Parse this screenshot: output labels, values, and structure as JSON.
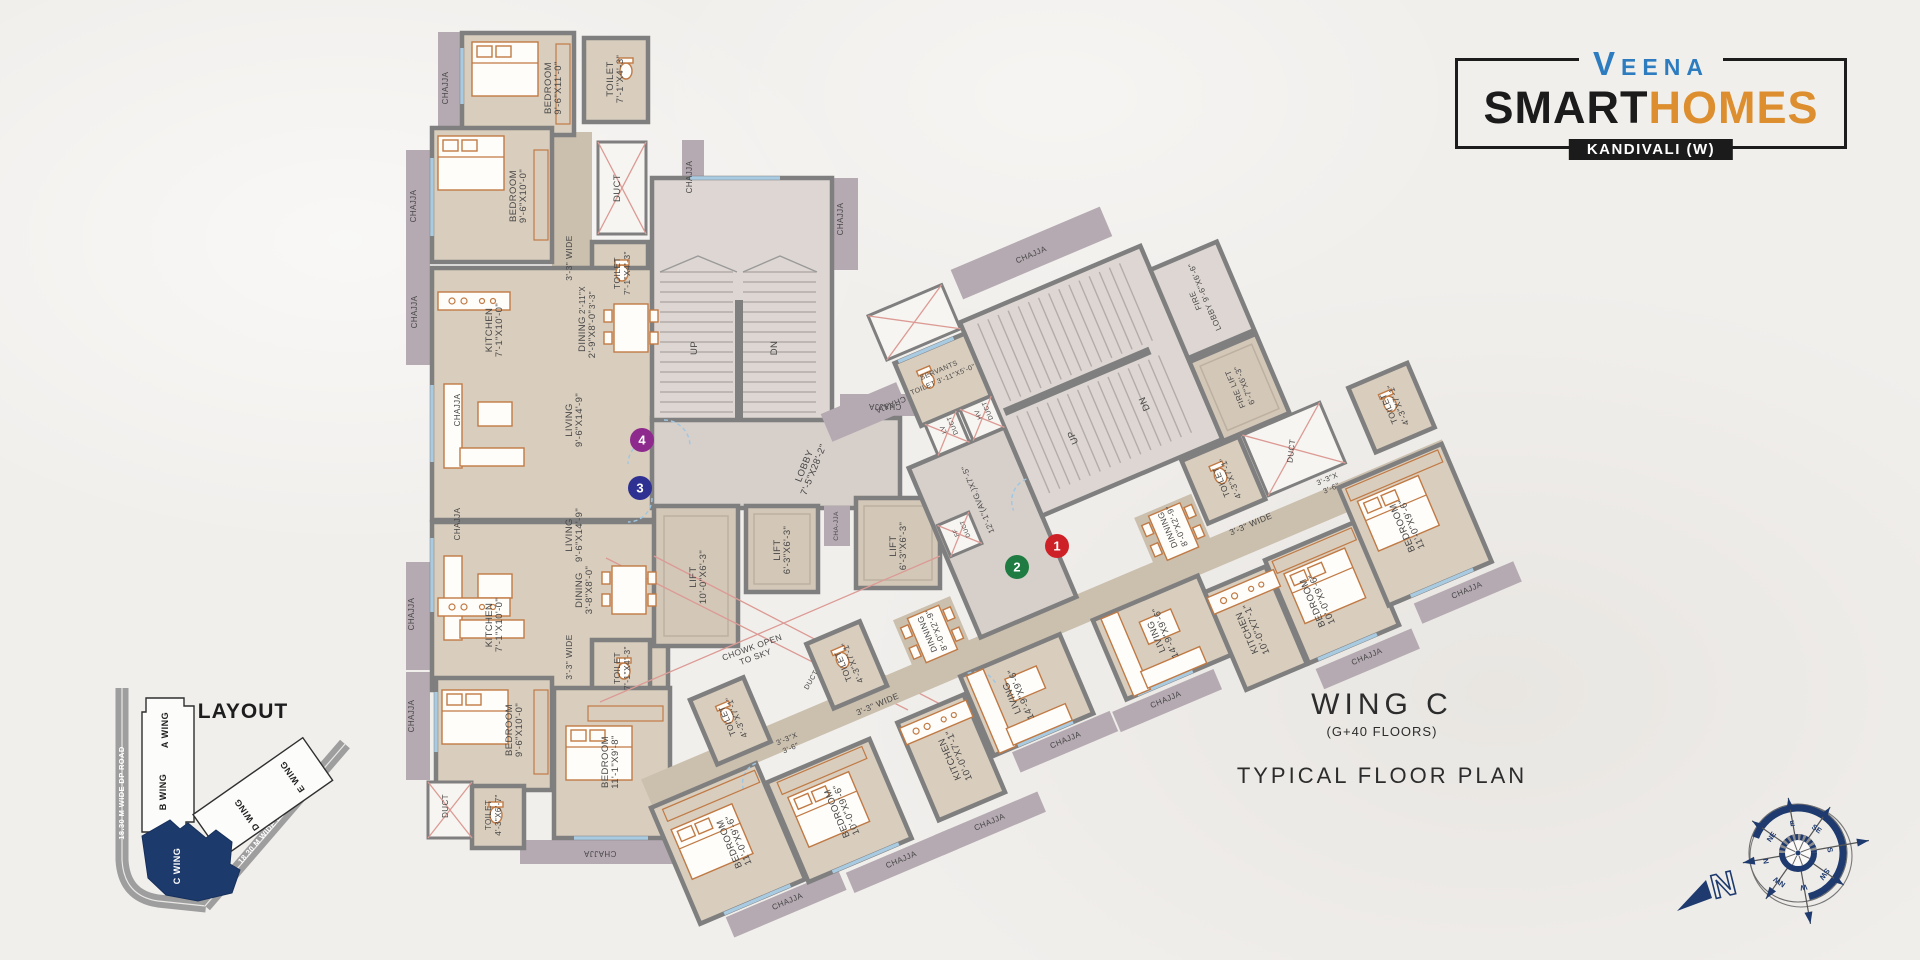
{
  "logo": {
    "brand": "VEENA",
    "smart": "SMART",
    "homes": "HOMES",
    "location": "KANDIVALI (W)"
  },
  "title": {
    "wing": "WING C",
    "floors": "(G+40 FLOORS)",
    "plan": "TYPICAL FLOOR PLAN"
  },
  "layout_map": {
    "title": "LAYOUT",
    "road_left": "18.30 M WIDE DP ROAD",
    "road_right": "18.30 M WIDE DP ROAD",
    "wings": [
      "A WING",
      "B WING",
      "C WING",
      "D WING",
      "E WING"
    ],
    "highlight_color": "#1d3a6d"
  },
  "compass": {
    "north": "N",
    "points": [
      "N",
      "NE",
      "E",
      "SE",
      "S",
      "SW",
      "W",
      "NW"
    ]
  },
  "badges": [
    {
      "label": "1",
      "color": "#ce2127"
    },
    {
      "label": "2",
      "color": "#1e7b41"
    },
    {
      "label": "3",
      "color": "#2e3192"
    },
    {
      "label": "4",
      "color": "#8e2a8d"
    }
  ],
  "plan_labels": [
    {
      "name": "BEDROOM",
      "dims": "9'-6\"X11'-0\"",
      "x": 551,
      "y": 88,
      "r": -90,
      "f": "L"
    },
    {
      "name": "TOILET",
      "dims": "7'-1\"X4'-3\"",
      "x": 613,
      "y": 79,
      "r": -90,
      "f": "L"
    },
    {
      "name": "BEDROOM",
      "dims": "9'-6\"X10'-0\"",
      "x": 516,
      "y": 196,
      "r": -90,
      "f": "L"
    },
    {
      "name": "2'-11\"X",
      "dims": "3'-3\"",
      "x": 585,
      "y": 300,
      "r": -90,
      "f": "L",
      "s": 8
    },
    {
      "name": "DUCT",
      "dims": "",
      "x": 620,
      "y": 188,
      "r": -90,
      "f": "L"
    },
    {
      "name": "TOILET",
      "dims": "7'-1\"X4'-3\"",
      "x": 620,
      "y": 273,
      "r": -90,
      "f": "L",
      "s": 8.5
    },
    {
      "name": "3'-3\" WIDE",
      "dims": "",
      "x": 572,
      "y": 258,
      "r": -90,
      "f": "L",
      "s": 8.5
    },
    {
      "name": "KITCHEN",
      "dims": "7'-1\"X10'-0\"",
      "x": 492,
      "y": 330,
      "r": -90,
      "f": "L"
    },
    {
      "name": "DINING",
      "dims": "2'-9\"X8'-0\"",
      "x": 585,
      "y": 334,
      "r": -90,
      "f": "L"
    },
    {
      "name": "LIVING",
      "dims": "9'-6\"X14'-9\"",
      "x": 572,
      "y": 420,
      "r": -90,
      "f": "L"
    },
    {
      "name": "LIVING",
      "dims": "9'-6\"X14'-9\"",
      "x": 572,
      "y": 535,
      "r": -90,
      "f": "L"
    },
    {
      "name": "DINING",
      "dims": "3'-8\"X8'-0\"",
      "x": 582,
      "y": 590,
      "r": -90,
      "f": "L"
    },
    {
      "name": "KITCHEN",
      "dims": "7'-1\"X10'-0\"",
      "x": 492,
      "y": 625,
      "r": -90,
      "f": "L"
    },
    {
      "name": "3'-3\" WIDE",
      "dims": "",
      "x": 572,
      "y": 657,
      "r": -90,
      "f": "L",
      "s": 8.5
    },
    {
      "name": "TOILET",
      "dims": "7'-1\"X4'-3\"",
      "x": 620,
      "y": 668,
      "r": -90,
      "f": "L",
      "s": 8.5
    },
    {
      "name": "BEDROOM",
      "dims": "9'-6\"X10'-0\"",
      "x": 512,
      "y": 730,
      "r": -90,
      "f": "L"
    },
    {
      "name": "BEDROOM",
      "dims": "11'-1\"X9'-8\"",
      "x": 608,
      "y": 762,
      "r": -90,
      "f": "L"
    },
    {
      "name": "TOILET",
      "dims": "4'-3\"X6'-7\"",
      "x": 491,
      "y": 815,
      "r": -90,
      "f": "L",
      "s": 8
    },
    {
      "name": "DUCT",
      "dims": "",
      "x": 448,
      "y": 806,
      "r": -90,
      "f": "L",
      "s": 8
    },
    {
      "name": "UP",
      "dims": "",
      "x": 697,
      "y": 348,
      "r": -90,
      "f": "L"
    },
    {
      "name": "DN",
      "dims": "",
      "x": 777,
      "y": 348,
      "r": -90,
      "f": "L"
    },
    {
      "name": "LOBBY",
      "dims": "7'-5\"X28'-2\"",
      "x": 807,
      "y": 467,
      "r": -68,
      "f": "L"
    },
    {
      "name": "LIFT",
      "dims": "10'-0\"X6'-3\"",
      "x": 696,
      "y": 577,
      "r": -90,
      "f": "L"
    },
    {
      "name": "LIFT",
      "dims": "6'-3\"X6'-3\"",
      "x": 780,
      "y": 550,
      "r": -90,
      "f": "L"
    },
    {
      "name": "LIFT",
      "dims": "6'-3\"X6'-3\"",
      "x": 896,
      "y": 546,
      "r": -90,
      "f": "L"
    },
    {
      "name": "CHA-JJA",
      "dims": "",
      "x": 838,
      "y": 526,
      "r": -90,
      "f": "L",
      "s": 6.5
    },
    {
      "name": "CHOWK OPEN",
      "dims": "TO SKY",
      "x": 753,
      "y": 650,
      "r": -20,
      "f": "L",
      "s": 8.5
    },
    {
      "name": "DUCT",
      "dims": "",
      "x": 813,
      "y": 681,
      "r": -60,
      "f": "L",
      "s": 7
    },
    {
      "name": "CHAJJA",
      "dims": "",
      "x": 448,
      "y": 88,
      "r": -90,
      "f": "L",
      "s": 8
    },
    {
      "name": "CHAJJA",
      "dims": "",
      "x": 416,
      "y": 206,
      "r": -90,
      "f": "L",
      "s": 8
    },
    {
      "name": "CHAJJA",
      "dims": "",
      "x": 417,
      "y": 312,
      "r": -90,
      "f": "L",
      "s": 8
    },
    {
      "name": "CHAJJA",
      "dims": "",
      "x": 460,
      "y": 410,
      "r": -90,
      "f": "L",
      "s": 8
    },
    {
      "name": "CHAJJA",
      "dims": "",
      "x": 460,
      "y": 524,
      "r": -90,
      "f": "L",
      "s": 8
    },
    {
      "name": "CHAJJA",
      "dims": "",
      "x": 414,
      "y": 614,
      "r": -90,
      "f": "L",
      "s": 8
    },
    {
      "name": "CHAJJA",
      "dims": "",
      "x": 414,
      "y": 716,
      "r": -90,
      "f": "L",
      "s": 8
    },
    {
      "name": "CHAJJA",
      "dims": "",
      "x": 600,
      "y": 851,
      "r": 180,
      "f": "L",
      "s": 8
    },
    {
      "name": "CHAJJA",
      "dims": "",
      "x": 692,
      "y": 177,
      "r": -90,
      "f": "L",
      "s": 8
    },
    {
      "name": "CHAJJA",
      "dims": "",
      "x": 843,
      "y": 219,
      "r": -90,
      "f": "L",
      "s": 8
    },
    {
      "name": "CHAJJA",
      "dims": "",
      "x": 885,
      "y": 404,
      "r": 180,
      "f": "L",
      "s": 8
    },
    {
      "name": "SERVANTS",
      "dims": "TOILET 3'-11\"X5'-0\"",
      "x": 1074,
      "y": 428,
      "r": 0,
      "f": "W",
      "s": 7
    },
    {
      "name": "LV",
      "dims": "DUCT",
      "x": 1057,
      "y": 482,
      "r": -90,
      "f": "W",
      "s": 6.5
    },
    {
      "name": "HV",
      "dims": "DUCT",
      "x": 1095,
      "y": 482,
      "r": -90,
      "f": "W",
      "s": 6.5
    },
    {
      "name": "UP",
      "dims": "",
      "x": 1174,
      "y": 540,
      "r": -90,
      "f": "W"
    },
    {
      "name": "DN",
      "dims": "",
      "x": 1253,
      "y": 537,
      "r": -90,
      "f": "W"
    },
    {
      "name": "FIRE",
      "dims": "LOBBY 9'-6\"X6'-6\"",
      "x": 1340,
      "y": 462,
      "r": -90,
      "f": "W",
      "s": 8
    },
    {
      "name": "FIRE LIFT",
      "dims": "6'-7\"X6'-3\"",
      "x": 1342,
      "y": 559,
      "r": -90,
      "f": "W",
      "s": 8
    },
    {
      "name": "12'-1\"(AVG.)X7'-5\"",
      "dims": "",
      "x": 1062,
      "y": 560,
      "r": -90,
      "f": "W",
      "s": 8
    },
    {
      "name": "FF",
      "dims": "DUCT",
      "x": 1028,
      "y": 582,
      "r": -90,
      "f": "W",
      "s": 6
    },
    {
      "name": "TOILET",
      "dims": "4'-3\"X7'-1\"",
      "x": 1293,
      "y": 639,
      "r": -90,
      "f": "W",
      "s": 8.5
    },
    {
      "name": "DUCT",
      "dims": "",
      "x": 1369,
      "y": 639,
      "r": -60,
      "f": "W",
      "s": 8
    },
    {
      "name": "TOILET",
      "dims": "4'-3\"X7'-1\"",
      "x": 1476,
      "y": 637,
      "r": -90,
      "f": "W",
      "s": 8.5
    },
    {
      "name": "3'-3\"X",
      "dims": "3'-6\"",
      "x": 1389,
      "y": 680,
      "r": 0,
      "f": "W",
      "s": 7.5
    },
    {
      "name": "3'-3\" WIDE",
      "dims": "",
      "x": 1301,
      "y": 692,
      "r": 0,
      "f": "W",
      "s": 8.5
    },
    {
      "name": "DINNING",
      "dims": "8'-0\"X2'-9\"",
      "x": 1225,
      "y": 662,
      "r": -90,
      "f": "W",
      "s": 8.5
    },
    {
      "name": "TOILET",
      "dims": "4'-3\"X7'-1\"",
      "x": 873,
      "y": 661,
      "r": -90,
      "f": "W",
      "s": 8.5
    },
    {
      "name": "DINNING",
      "dims": "8'-0\"X2'-9\"",
      "x": 963,
      "y": 664,
      "r": -90,
      "f": "W",
      "s": 8.5
    },
    {
      "name": "TOILET",
      "dims": "4'-3\"X7'-1\"",
      "x": 745,
      "y": 666,
      "r": -90,
      "f": "W",
      "s": 8.5
    },
    {
      "name": "3'-3\"X",
      "dims": "3'-6\"",
      "x": 790,
      "y": 708,
      "r": 0,
      "f": "W",
      "s": 7.5
    },
    {
      "name": "3'-3\" WIDE",
      "dims": "",
      "x": 887,
      "y": 712,
      "r": 0,
      "f": "W",
      "s": 8.5
    },
    {
      "name": "LIVING",
      "dims": "14'-9\"X9'-6\"",
      "x": 1016,
      "y": 756,
      "r": -90,
      "f": "W"
    },
    {
      "name": "LIVING",
      "dims": "14'-9\"X9'-6\"",
      "x": 1173,
      "y": 756,
      "r": -90,
      "f": "W"
    },
    {
      "name": "KITCHEN",
      "dims": "10'-0\"X7'-1\"",
      "x": 935,
      "y": 788,
      "r": -90,
      "f": "W"
    },
    {
      "name": "KITCHEN",
      "dims": "10'-0\"X7'-1\"",
      "x": 1258,
      "y": 788,
      "r": -90,
      "f": "W"
    },
    {
      "name": "BEDROOM",
      "dims": "10'-0\"X9'-6\"",
      "x": 810,
      "y": 794,
      "r": -90,
      "f": "W"
    },
    {
      "name": "BEDROOM",
      "dims": "10'-0\"X9'-6\"",
      "x": 1330,
      "y": 786,
      "r": -90,
      "f": "W"
    },
    {
      "name": "BEDROOM",
      "dims": "11'-0\"X9'-6\"",
      "x": 699,
      "y": 780,
      "r": -90,
      "f": "W"
    },
    {
      "name": "BEDROOM",
      "dims": "11'-0\"X9'-6\"",
      "x": 1442,
      "y": 752,
      "r": -90,
      "f": "W"
    },
    {
      "name": "CHAJJA",
      "dims": "",
      "x": 1204,
      "y": 358,
      "r": 0,
      "f": "W",
      "s": 8
    },
    {
      "name": "CHAJJA",
      "dims": "",
      "x": 1016,
      "y": 436,
      "r": 180,
      "f": "W",
      "s": 8
    },
    {
      "name": "CHAJJA",
      "dims": "",
      "x": 1474,
      "y": 837,
      "r": 0,
      "f": "W",
      "s": 8
    },
    {
      "name": "CHAJJA",
      "dims": "",
      "x": 1356,
      "y": 859,
      "r": 0,
      "f": "W",
      "s": 8
    },
    {
      "name": "CHAJJA",
      "dims": "",
      "x": 1154,
      "y": 820,
      "r": 0,
      "f": "W",
      "s": 8
    },
    {
      "name": "CHAJJA",
      "dims": "",
      "x": 1046,
      "y": 818,
      "r": 0,
      "f": "W",
      "s": 8
    },
    {
      "name": "CHAJJA",
      "dims": "",
      "x": 944,
      "y": 864,
      "r": 0,
      "f": "W",
      "s": 8
    },
    {
      "name": "CHAJJA",
      "dims": "",
      "x": 848,
      "y": 864,
      "r": 0,
      "f": "W",
      "s": 8
    },
    {
      "name": "CHAJJA",
      "dims": "",
      "x": 727,
      "y": 858,
      "r": 0,
      "f": "W",
      "s": 8
    }
  ]
}
